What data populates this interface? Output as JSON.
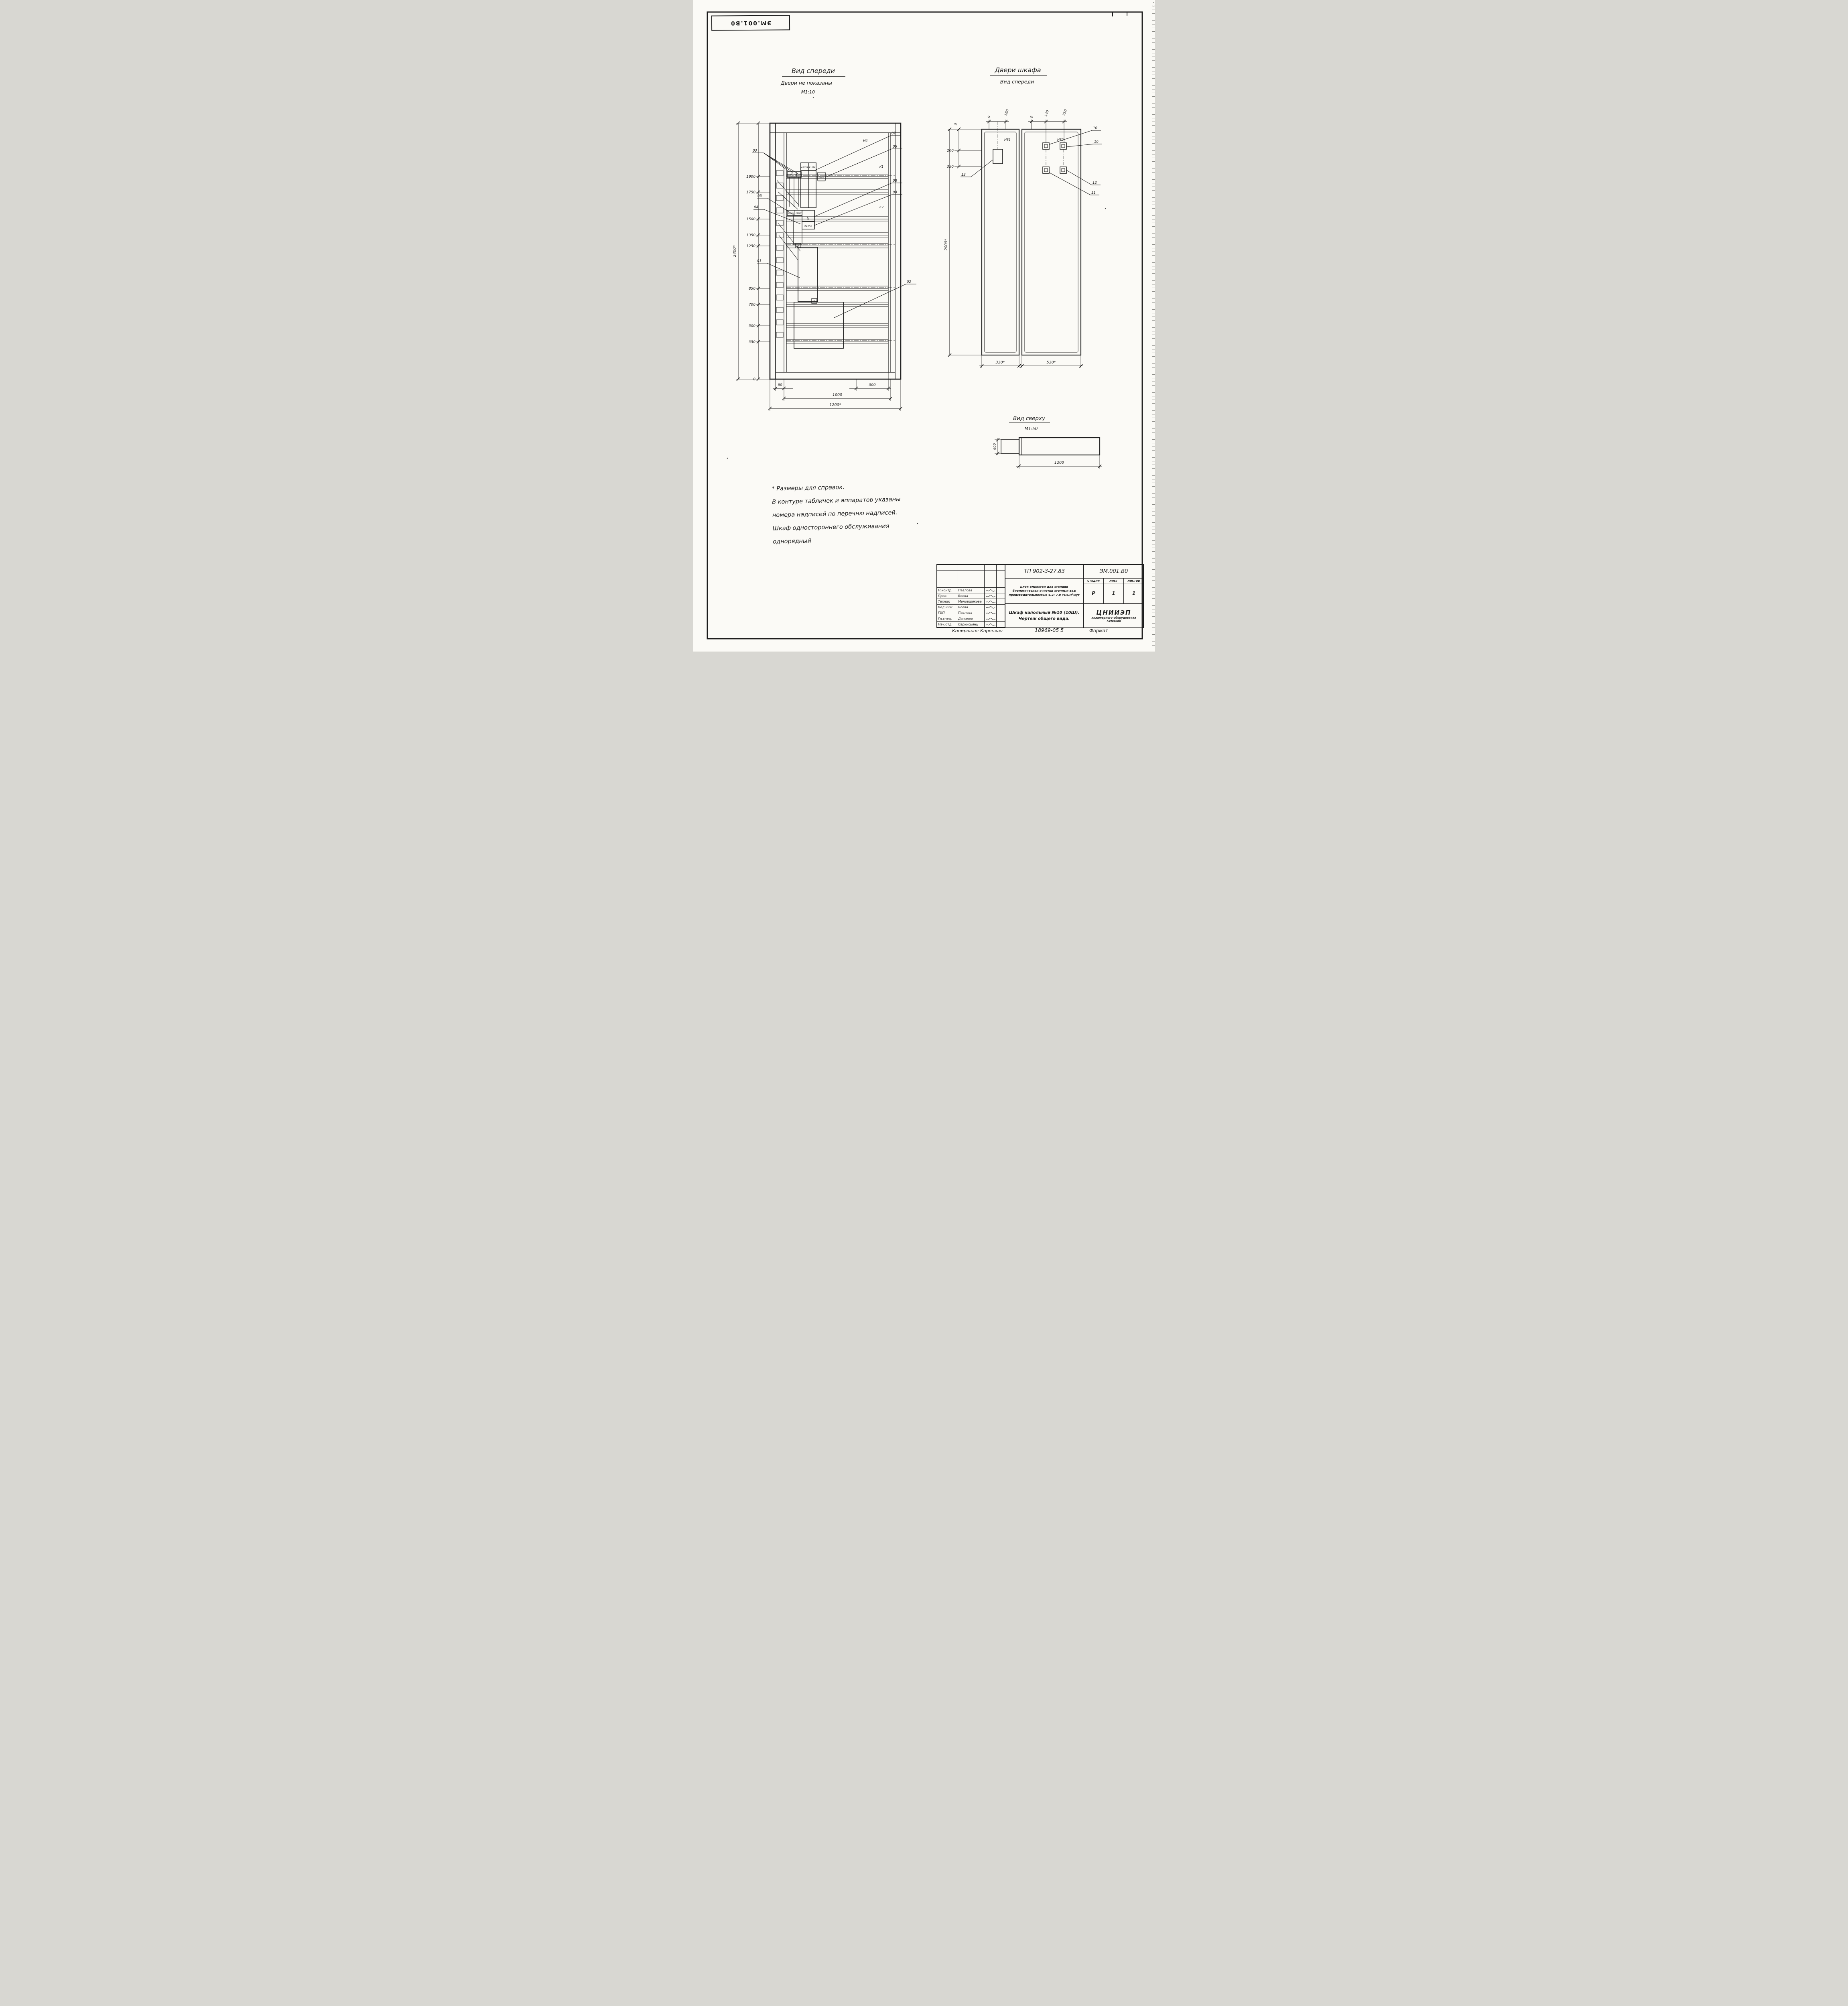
{
  "sheet": {
    "stamp_code": "ЭМ.001.В0",
    "copied_by": "Копировал: Корецкая",
    "doc_number_bottom": "18969-05  5",
    "format_note": "Формат"
  },
  "front_view": {
    "title": "Вид спереди",
    "subtitle": "Двери не показаны",
    "scale": "М1:10",
    "labels": {
      "h1": "Н1",
      "k1": "К1",
      "k2": "К2",
      "c": "Ц"
    },
    "component_labels": [
      "#10К1",
      "#10К2",
      "#10К3",
      "#10ТА",
      "#10ТА",
      "#10Fu",
      "#10КК",
      "#10КТ",
      "#10R1"
    ],
    "chip_label": "2",
    "callouts": [
      "01",
      "02",
      "03",
      "04",
      "05",
      "06",
      "07",
      "08",
      "09"
    ],
    "dims_left": [
      "1900",
      "1750",
      "1500",
      "1350",
      "1250",
      "850",
      "700",
      "500",
      "350",
      "0"
    ],
    "dim_overall_height": "2400*",
    "dims_bottom": [
      "60",
      "300",
      "1000",
      "1200*"
    ]
  },
  "doors_view": {
    "title": "Двери шкафа",
    "subtitle": "Вид спереди",
    "labels": {
      "h51": "Н51",
      "h52": "Н52"
    },
    "callouts": [
      "10",
      "10",
      "11",
      "12",
      "13"
    ],
    "dims_top_left": [
      "0",
      "160"
    ],
    "dims_top_right": [
      "0",
      "140",
      "310"
    ],
    "dims_side": [
      "0",
      "200",
      "350"
    ],
    "dim_overall_height": "2000*",
    "dims_bottom": [
      "330*",
      "530*"
    ]
  },
  "top_view": {
    "title": "Вид сверху",
    "scale": "М1:50",
    "dims": [
      "600",
      "1200"
    ]
  },
  "notes": [
    "* Размеры для справок.",
    "В контуре табличек и аппаратов указаны",
    "номера надписей по перечню надписей.",
    "Шкаф одностороннего обслуживания",
    "однорядный"
  ],
  "title_block": {
    "doc_type": "ТП 902-3-27.83",
    "doc_code": "ЭМ.001.В0",
    "project": [
      "Блок емкостей для станции",
      "биологической очистки сточных вод",
      "производительностью 4,2; 7,0 тыс.м³/сут"
    ],
    "drawing_title": [
      "Шкаф напольный №10 (10Ш).",
      "Чертеж общего вида."
    ],
    "stage_header": "СТАДИЯ",
    "sheet_header": "ЛИСТ",
    "sheets_header": "ЛИСТОВ",
    "stage": "Р",
    "sheet": "1",
    "sheets": "1",
    "org": [
      "ЦНИИЭП",
      "инженерного оборудования",
      "г.Москва"
    ],
    "people": [
      {
        "role": "Н.контр.",
        "name": "Павлова"
      },
      {
        "role": "Пров.",
        "name": "Боева"
      },
      {
        "role": "Техник",
        "name": "Меновщикова"
      },
      {
        "role": "Вед.инж.",
        "name": "Боева"
      },
      {
        "role": "ГИП",
        "name": "Павлова"
      },
      {
        "role": "Гл.спец.",
        "name": "Данилов"
      },
      {
        "role": "Нач.отд.",
        "name": "Саркисьянц"
      }
    ]
  }
}
